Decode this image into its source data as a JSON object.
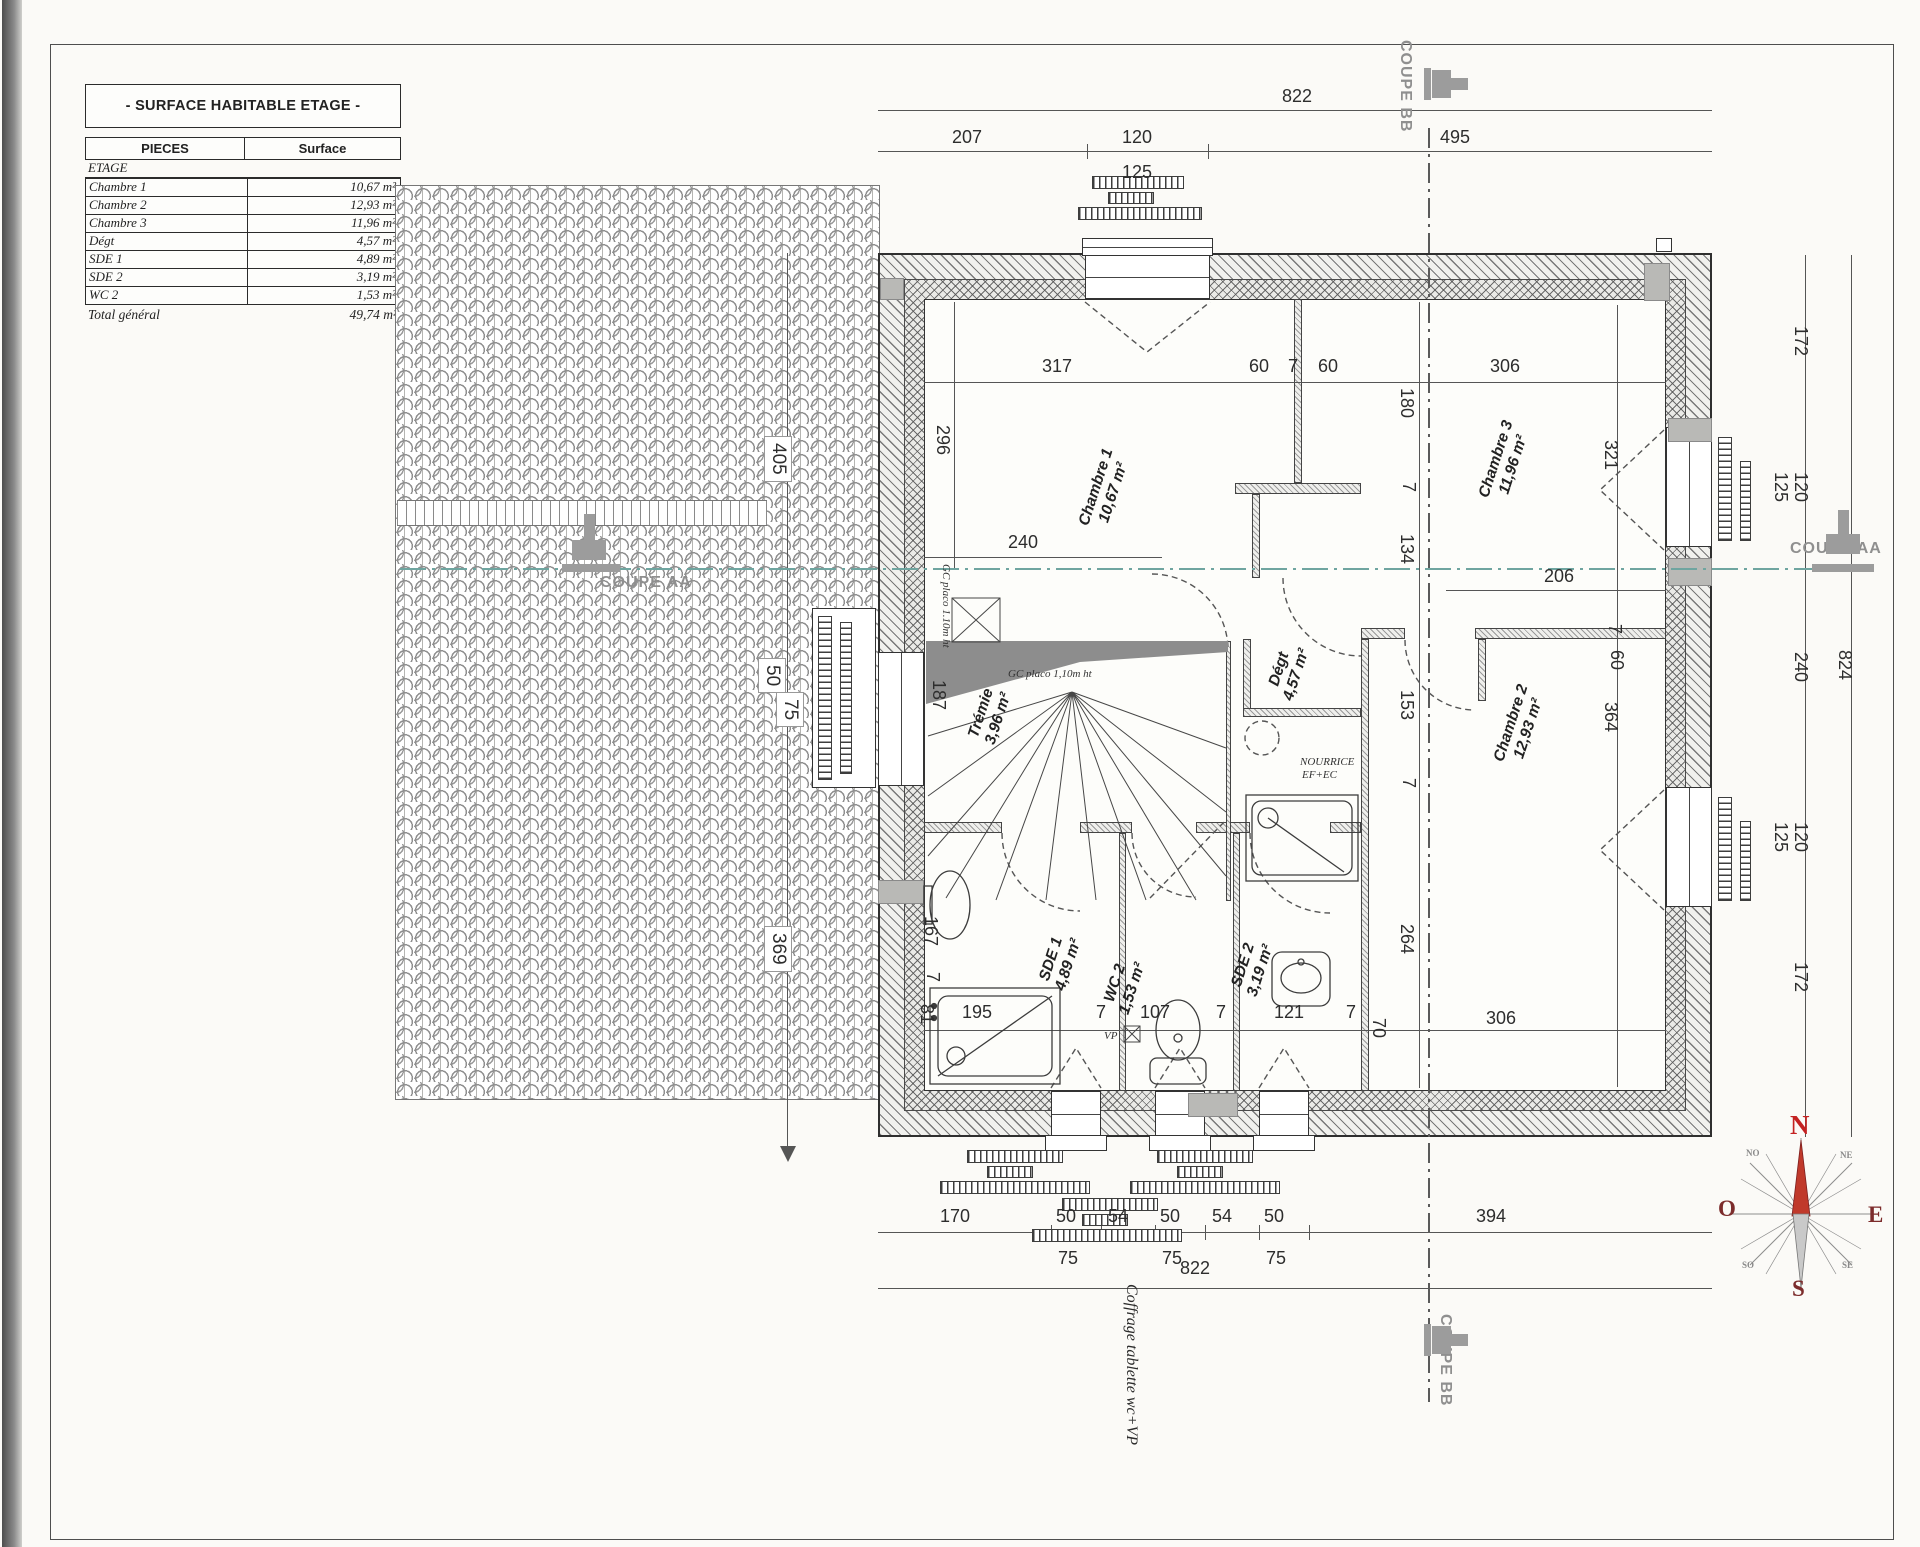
{
  "table": {
    "title": "- SURFACE HABITABLE ETAGE -",
    "col_pieces": "PIECES",
    "col_surface": "Surface",
    "section": "ETAGE",
    "rows": [
      {
        "piece": "Chambre 1",
        "surface": "10,67 m²"
      },
      {
        "piece": "Chambre 2",
        "surface": "12,93 m²"
      },
      {
        "piece": "Chambre 3",
        "surface": "11,96 m²"
      },
      {
        "piece": "Dégt",
        "surface": "4,57 m²"
      },
      {
        "piece": "SDE 1",
        "surface": "4,89 m²"
      },
      {
        "piece": "SDE 2",
        "surface": "3,19 m²"
      },
      {
        "piece": "WC 2",
        "surface": "1,53 m²"
      }
    ],
    "total_label": "Total général",
    "total_value": "49,74 m²"
  },
  "rooms": [
    {
      "name": "Chambre 1",
      "area": "10,67 m²",
      "x": 1105,
      "y": 490
    },
    {
      "name": "Chambre 3",
      "area": "11,96 m²",
      "x": 1505,
      "y": 462
    },
    {
      "name": "Chambre 2",
      "area": "12,93 m²",
      "x": 1520,
      "y": 726
    },
    {
      "name": "Dégt",
      "area": "4,57 m²",
      "x": 1288,
      "y": 672
    },
    {
      "name": "Trémie",
      "area": "3,96 m²",
      "x": 990,
      "y": 716
    },
    {
      "name": "SDE 1",
      "area": "4,89 m²",
      "x": 1060,
      "y": 962
    },
    {
      "name": "WC 2",
      "area": "1,53 m²",
      "x": 1124,
      "y": 986
    },
    {
      "name": "SDE 2",
      "area": "3,19 m²",
      "x": 1252,
      "y": 968
    }
  ],
  "labels": [
    {
      "t": "822",
      "x": 1282,
      "y": 86,
      "k": "h"
    },
    {
      "t": "207",
      "x": 952,
      "y": 127,
      "k": "h"
    },
    {
      "t": "120",
      "x": 1122,
      "y": 127,
      "k": "h"
    },
    {
      "t": "125",
      "x": 1122,
      "y": 162,
      "k": "h"
    },
    {
      "t": "495",
      "x": 1440,
      "y": 127,
      "k": "h"
    },
    {
      "t": "317",
      "x": 1042,
      "y": 356,
      "k": "h"
    },
    {
      "t": "60",
      "x": 1249,
      "y": 356,
      "k": "h"
    },
    {
      "t": "7",
      "x": 1288,
      "y": 356,
      "k": "h"
    },
    {
      "t": "60",
      "x": 1318,
      "y": 356,
      "k": "h"
    },
    {
      "t": "306",
      "x": 1490,
      "y": 356,
      "k": "h"
    },
    {
      "t": "240",
      "x": 1008,
      "y": 532,
      "k": "h"
    },
    {
      "t": "206",
      "x": 1544,
      "y": 566,
      "k": "h"
    },
    {
      "t": "306",
      "x": 1486,
      "y": 1008,
      "k": "h"
    },
    {
      "t": "195",
      "x": 962,
      "y": 1002,
      "k": "h"
    },
    {
      "t": "7",
      "x": 1096,
      "y": 1002,
      "k": "h"
    },
    {
      "t": "107",
      "x": 1140,
      "y": 1002,
      "k": "h"
    },
    {
      "t": "7",
      "x": 1216,
      "y": 1002,
      "k": "h"
    },
    {
      "t": "121",
      "x": 1274,
      "y": 1002,
      "k": "h"
    },
    {
      "t": "7",
      "x": 1346,
      "y": 1002,
      "k": "h"
    },
    {
      "t": "170",
      "x": 940,
      "y": 1206,
      "k": "h"
    },
    {
      "t": "50",
      "x": 1056,
      "y": 1206,
      "k": "h"
    },
    {
      "t": "54",
      "x": 1108,
      "y": 1206,
      "k": "h"
    },
    {
      "t": "50",
      "x": 1160,
      "y": 1206,
      "k": "h"
    },
    {
      "t": "54",
      "x": 1212,
      "y": 1206,
      "k": "h"
    },
    {
      "t": "50",
      "x": 1264,
      "y": 1206,
      "k": "h"
    },
    {
      "t": "394",
      "x": 1476,
      "y": 1206,
      "k": "h"
    },
    {
      "t": "75",
      "x": 1058,
      "y": 1248,
      "k": "h"
    },
    {
      "t": "75",
      "x": 1162,
      "y": 1248,
      "k": "h"
    },
    {
      "t": "75",
      "x": 1266,
      "y": 1248,
      "k": "h"
    },
    {
      "t": "822",
      "x": 1180,
      "y": 1258,
      "k": "h"
    },
    {
      "t": "296",
      "x": 932,
      "y": 425,
      "k": "v"
    },
    {
      "t": "321",
      "x": 1600,
      "y": 440,
      "k": "v"
    },
    {
      "t": "7",
      "x": 1604,
      "y": 624,
      "k": "v"
    },
    {
      "t": "60",
      "x": 1606,
      "y": 650,
      "k": "v"
    },
    {
      "t": "364",
      "x": 1600,
      "y": 702,
      "k": "v"
    },
    {
      "t": "180",
      "x": 1396,
      "y": 388,
      "k": "v"
    },
    {
      "t": "7",
      "x": 1398,
      "y": 482,
      "k": "v"
    },
    {
      "t": "134",
      "x": 1396,
      "y": 534,
      "k": "v"
    },
    {
      "t": "153",
      "x": 1396,
      "y": 690,
      "k": "v"
    },
    {
      "t": "7",
      "x": 1398,
      "y": 778,
      "k": "v"
    },
    {
      "t": "264",
      "x": 1396,
      "y": 924,
      "k": "v"
    },
    {
      "t": "187",
      "x": 928,
      "y": 680,
      "k": "v"
    },
    {
      "t": "167",
      "x": 920,
      "y": 916,
      "k": "v"
    },
    {
      "t": "7",
      "x": 922,
      "y": 972,
      "k": "v"
    },
    {
      "t": "81",
      "x": 916,
      "y": 1004,
      "k": "v"
    },
    {
      "t": "70",
      "x": 1368,
      "y": 1018,
      "k": "v"
    },
    {
      "t": "172",
      "x": 1790,
      "y": 326,
      "k": "v"
    },
    {
      "t": "125",
      "x": 1770,
      "y": 472,
      "k": "v"
    },
    {
      "t": "120",
      "x": 1790,
      "y": 472,
      "k": "v"
    },
    {
      "t": "240",
      "x": 1790,
      "y": 652,
      "k": "v"
    },
    {
      "t": "125",
      "x": 1770,
      "y": 822,
      "k": "v"
    },
    {
      "t": "120",
      "x": 1790,
      "y": 822,
      "k": "v"
    },
    {
      "t": "172",
      "x": 1790,
      "y": 962,
      "k": "v"
    },
    {
      "t": "824",
      "x": 1834,
      "y": 650,
      "k": "v"
    },
    {
      "t": "405",
      "x": 764,
      "y": 436,
      "k": "rb"
    },
    {
      "t": "50",
      "x": 758,
      "y": 658,
      "k": "rb"
    },
    {
      "t": "75",
      "x": 776,
      "y": 692,
      "k": "rb"
    },
    {
      "t": "369",
      "x": 764,
      "y": 926,
      "k": "rb"
    },
    {
      "t": "GC placo 1,10m ht",
      "x": 1008,
      "y": 668,
      "k": "a"
    },
    {
      "t": "GC placo 1.10m ht",
      "x": 940,
      "y": 564,
      "k": "av"
    },
    {
      "t": "NOURRICE",
      "x": 1300,
      "y": 756,
      "k": "a"
    },
    {
      "t": "EF+EC",
      "x": 1302,
      "y": 769,
      "k": "a"
    },
    {
      "t": "VP",
      "x": 1104,
      "y": 1030,
      "k": "a"
    },
    {
      "t": "Coffrage tablette wc+VP",
      "x": 1122,
      "y": 1284,
      "k": "as"
    },
    {
      "t": "COUPE AA",
      "x": 600,
      "y": 574,
      "k": "c"
    },
    {
      "t": "COUPE AA",
      "x": 1790,
      "y": 540,
      "k": "c"
    },
    {
      "t": "COUPE BB",
      "x": 1396,
      "y": 40,
      "k": "cv"
    },
    {
      "t": "COUPE BB",
      "x": 1436,
      "y": 1314,
      "k": "cv"
    }
  ],
  "lines": [
    {
      "x": 878,
      "y": 110,
      "w": 834,
      "h": 1
    },
    {
      "x": 878,
      "y": 151,
      "w": 834,
      "h": 1
    },
    {
      "x": 1087,
      "y": 144,
      "w": 1,
      "h": 15
    },
    {
      "x": 1208,
      "y": 144,
      "w": 1,
      "h": 15
    },
    {
      "x": 878,
      "y": 1232,
      "w": 834,
      "h": 1
    },
    {
      "x": 878,
      "y": 1288,
      "w": 834,
      "h": 1
    },
    {
      "x": 1051,
      "y": 1225,
      "w": 1,
      "h": 15
    },
    {
      "x": 1101,
      "y": 1225,
      "w": 1,
      "h": 15
    },
    {
      "x": 1155,
      "y": 1225,
      "w": 1,
      "h": 15
    },
    {
      "x": 1205,
      "y": 1225,
      "w": 1,
      "h": 15
    },
    {
      "x": 1259,
      "y": 1225,
      "w": 1,
      "h": 15
    },
    {
      "x": 1309,
      "y": 1225,
      "w": 1,
      "h": 15
    },
    {
      "x": 1805,
      "y": 255,
      "w": 1,
      "h": 882
    },
    {
      "x": 1851,
      "y": 255,
      "w": 1,
      "h": 882
    },
    {
      "x": 787,
      "y": 253,
      "w": 1,
      "h": 894
    },
    {
      "x": 924,
      "y": 382,
      "w": 742,
      "h": 1
    },
    {
      "x": 924,
      "y": 557,
      "w": 238,
      "h": 1
    },
    {
      "x": 954,
      "y": 302,
      "w": 1,
      "h": 266
    },
    {
      "x": 1617,
      "y": 305,
      "w": 1,
      "h": 782
    },
    {
      "x": 1419,
      "y": 302,
      "w": 1,
      "h": 786
    },
    {
      "x": 924,
      "y": 1030,
      "w": 742,
      "h": 1
    },
    {
      "x": 1446,
      "y": 590,
      "w": 220,
      "h": 1
    }
  ],
  "shutters": [
    {
      "x": 1092,
      "y": 176,
      "w": 92,
      "h": 13,
      "o": "h"
    },
    {
      "x": 1108,
      "y": 192,
      "w": 46,
      "h": 12,
      "o": "h"
    },
    {
      "x": 1078,
      "y": 207,
      "w": 124,
      "h": 13,
      "o": "h"
    },
    {
      "x": 967,
      "y": 1150,
      "w": 96,
      "h": 13,
      "o": "h"
    },
    {
      "x": 987,
      "y": 1166,
      "w": 46,
      "h": 12,
      "o": "h"
    },
    {
      "x": 940,
      "y": 1181,
      "w": 150,
      "h": 13,
      "o": "h"
    },
    {
      "x": 1157,
      "y": 1150,
      "w": 96,
      "h": 13,
      "o": "h"
    },
    {
      "x": 1177,
      "y": 1166,
      "w": 46,
      "h": 12,
      "o": "h"
    },
    {
      "x": 1130,
      "y": 1181,
      "w": 150,
      "h": 13,
      "o": "h"
    },
    {
      "x": 1062,
      "y": 1198,
      "w": 96,
      "h": 13,
      "o": "h"
    },
    {
      "x": 1082,
      "y": 1214,
      "w": 46,
      "h": 12,
      "o": "h"
    },
    {
      "x": 1032,
      "y": 1229,
      "w": 150,
      "h": 13,
      "o": "h"
    },
    {
      "x": 1718,
      "y": 437,
      "w": 14,
      "h": 104,
      "o": "v"
    },
    {
      "x": 1740,
      "y": 461,
      "w": 11,
      "h": 80,
      "o": "v"
    },
    {
      "x": 1718,
      "y": 797,
      "w": 14,
      "h": 104,
      "o": "v"
    },
    {
      "x": 1740,
      "y": 821,
      "w": 11,
      "h": 80,
      "o": "v"
    },
    {
      "x": 818,
      "y": 616,
      "w": 14,
      "h": 164,
      "o": "v"
    },
    {
      "x": 840,
      "y": 622,
      "w": 12,
      "h": 152,
      "o": "v"
    }
  ],
  "blocks": [
    {
      "x": 880,
      "y": 278,
      "w": 22,
      "h": 20
    },
    {
      "x": 1644,
      "y": 263,
      "w": 24,
      "h": 36
    },
    {
      "x": 1668,
      "y": 418,
      "w": 42,
      "h": 22
    },
    {
      "x": 1668,
      "y": 558,
      "w": 42,
      "h": 26
    },
    {
      "x": 1188,
      "y": 1093,
      "w": 48,
      "h": 22
    },
    {
      "x": 878,
      "y": 880,
      "w": 44,
      "h": 22
    }
  ],
  "compass": {
    "letters": [
      {
        "t": "N",
        "x": 74,
        "y": -8,
        "k": "n"
      },
      {
        "t": "O",
        "x": 2,
        "y": 78,
        "k": "m"
      },
      {
        "t": "E",
        "x": 152,
        "y": 84,
        "k": "m"
      },
      {
        "t": "S",
        "x": 76,
        "y": 158,
        "k": "m"
      },
      {
        "t": "NO",
        "x": 30,
        "y": 30,
        "k": "s2"
      },
      {
        "t": "NE",
        "x": 124,
        "y": 32,
        "k": "s2"
      },
      {
        "t": "SO",
        "x": 26,
        "y": 142,
        "k": "s2"
      },
      {
        "t": "SE",
        "x": 126,
        "y": 142,
        "k": "s2"
      }
    ]
  },
  "colors": {
    "section_teal": "#6fa5a0",
    "section_gray": "#9c9c9c",
    "compass_north_red": "#c42222",
    "compass_letter_maroon": "#7c2c2c",
    "line_dark": "#2f2f2f"
  }
}
